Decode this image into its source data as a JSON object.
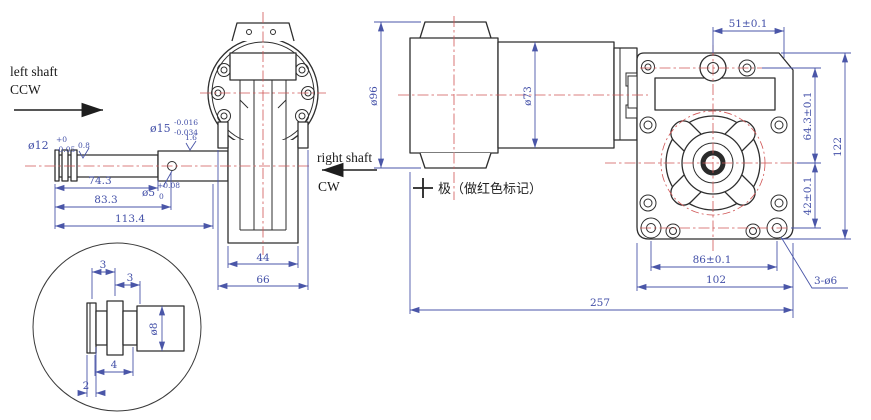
{
  "labels": {
    "left_shaft": "left shaft",
    "left_shaft_direction": "CCW",
    "right_shaft": "right shaft",
    "right_shaft_direction": "CW",
    "polarity_note": "极（做红色标记）"
  },
  "shaft_view": {
    "dia12": "ø12",
    "dia12_tol_upper": "+0",
    "dia12_tol_lower": "-0.05",
    "dia15": "ø15",
    "dia15_tol_upper": "-0.016",
    "dia15_tol_lower": "-0.034",
    "dia5": "ø5",
    "dia5_tol_upper": "+0.08",
    "dia5_tol_lower": "0",
    "roughness_a": "0.8",
    "roughness_b": "1.6",
    "length_a": "74.3",
    "length_b": "83.3",
    "length_c": "113.4"
  },
  "front_view": {
    "width_inner": "44",
    "width_outer": "66"
  },
  "detail_view": {
    "seg_a": "3",
    "seg_b": "3",
    "seg_c": "4",
    "seg_d": "2",
    "dia8": "ø8"
  },
  "side_view": {
    "dia96": "ø96",
    "dia73": "ø73",
    "dim_top": "51±0.1",
    "dim_right_upper": "64.3±0.1",
    "dim_right_outer": "122",
    "dim_right_lower": "42±0.1",
    "dim_bottom_a": "86±0.1",
    "dim_bottom_b": "102",
    "dim_overall": "257",
    "mount_holes": "3-ø6"
  },
  "colors": {
    "outline": "#2e2e2e",
    "dimension": "#4a56a8",
    "centerline": "#d05555",
    "background": "#ffffff"
  }
}
